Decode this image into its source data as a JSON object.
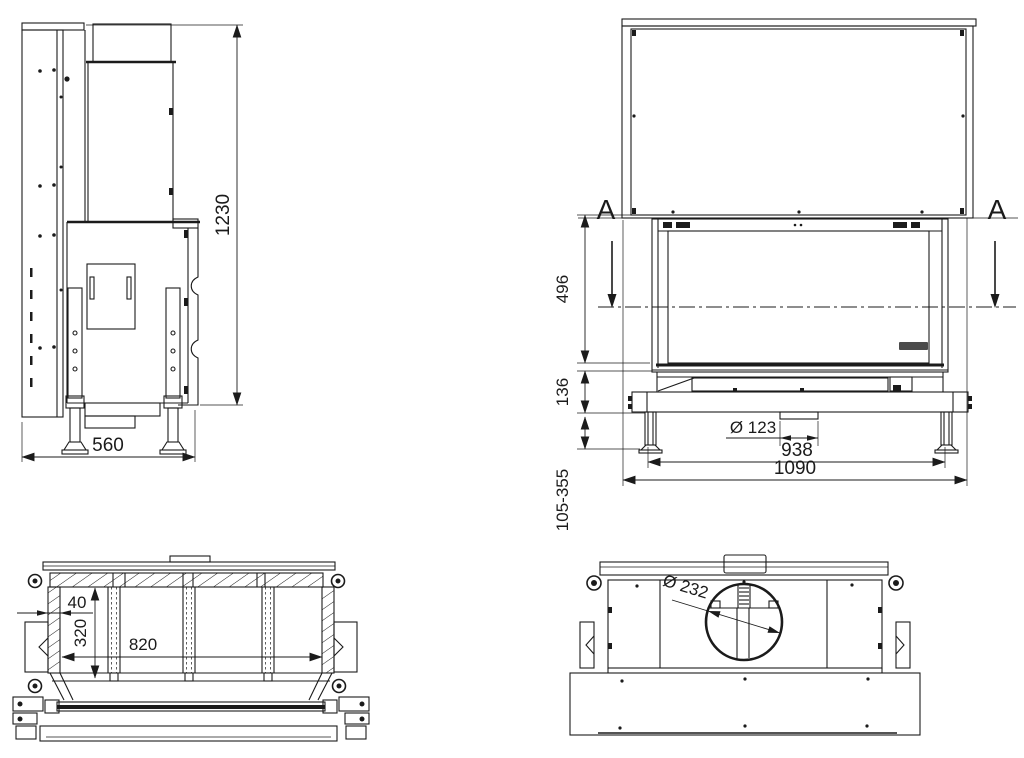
{
  "page": {
    "background": "#ffffff",
    "line_color": "#1b1b1b",
    "kind": "technical drawing, 4 orthographic views of a fireplace insert"
  },
  "views": {
    "side": {
      "label": "side-view",
      "height": "1230",
      "depth": "560"
    },
    "front": {
      "label": "front-view",
      "section_a_left": "A",
      "section_a_right": "A",
      "glass_height": "496",
      "base_height": "136",
      "leg_range": "105-355",
      "flue_spigot": "Ø 123",
      "inner_width": "938",
      "overall_width": "1090"
    },
    "section": {
      "label": "section-view",
      "wall": "40",
      "depth": "320",
      "width": "820"
    },
    "top": {
      "label": "top-view",
      "flue_diameter": "Ø 232"
    }
  }
}
